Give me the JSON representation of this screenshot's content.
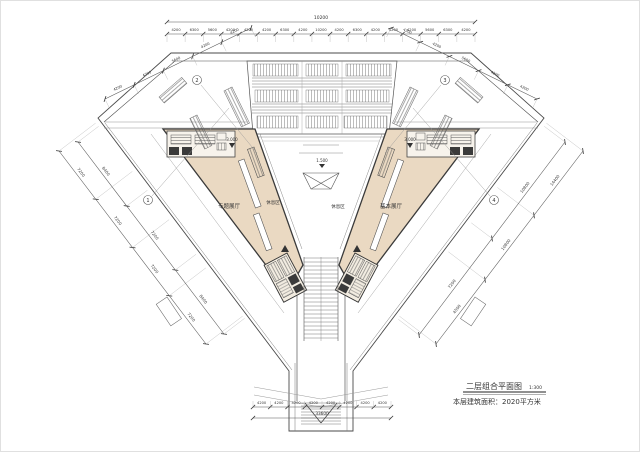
{
  "drawing": {
    "title": "二层组合平面图",
    "scale": "1:300",
    "area_note": "本层建筑面积：2020平方米"
  },
  "rooms": {
    "left_hall": "专题展厅",
    "left_rest": "休息区",
    "right_rest": "休息区",
    "right_hall": "基本展厅"
  },
  "levels": {
    "left": "3.000",
    "center": "1.500",
    "right": "3.000"
  },
  "grid": [
    "1",
    "2",
    "3",
    "4"
  ],
  "dimensions": {
    "top_overall": "10200",
    "top_segments": [
      "4200",
      "6300",
      "5600",
      "4200",
      "4200",
      "4200",
      "6300",
      "4200",
      "10200",
      "4200",
      "6300",
      "4200",
      "4200",
      "4200",
      "5600",
      "6300",
      "4200"
    ],
    "bottom_segments": [
      "4200",
      "4200",
      "4200",
      "4200",
      "4200",
      "4200",
      "4200",
      "4200"
    ],
    "bottom_overall": "33600",
    "left_outer": [
      "7200",
      "7200",
      "7200",
      "7200"
    ],
    "left_inner": [
      "8400",
      "7200",
      "8400"
    ],
    "right_outer": [
      "4500",
      "10800",
      "14400"
    ],
    "right_inner": [
      "7200",
      "10800"
    ],
    "upper_left": [
      "4200",
      "4200",
      "5600",
      "4200",
      "4200"
    ],
    "upper_right": [
      "4200",
      "4200",
      "5600",
      "4200",
      "4200"
    ]
  },
  "colors": {
    "floor_fill": "#ead9c2",
    "line": "#4a4a4a",
    "core_fill": "#3b3b3b"
  }
}
